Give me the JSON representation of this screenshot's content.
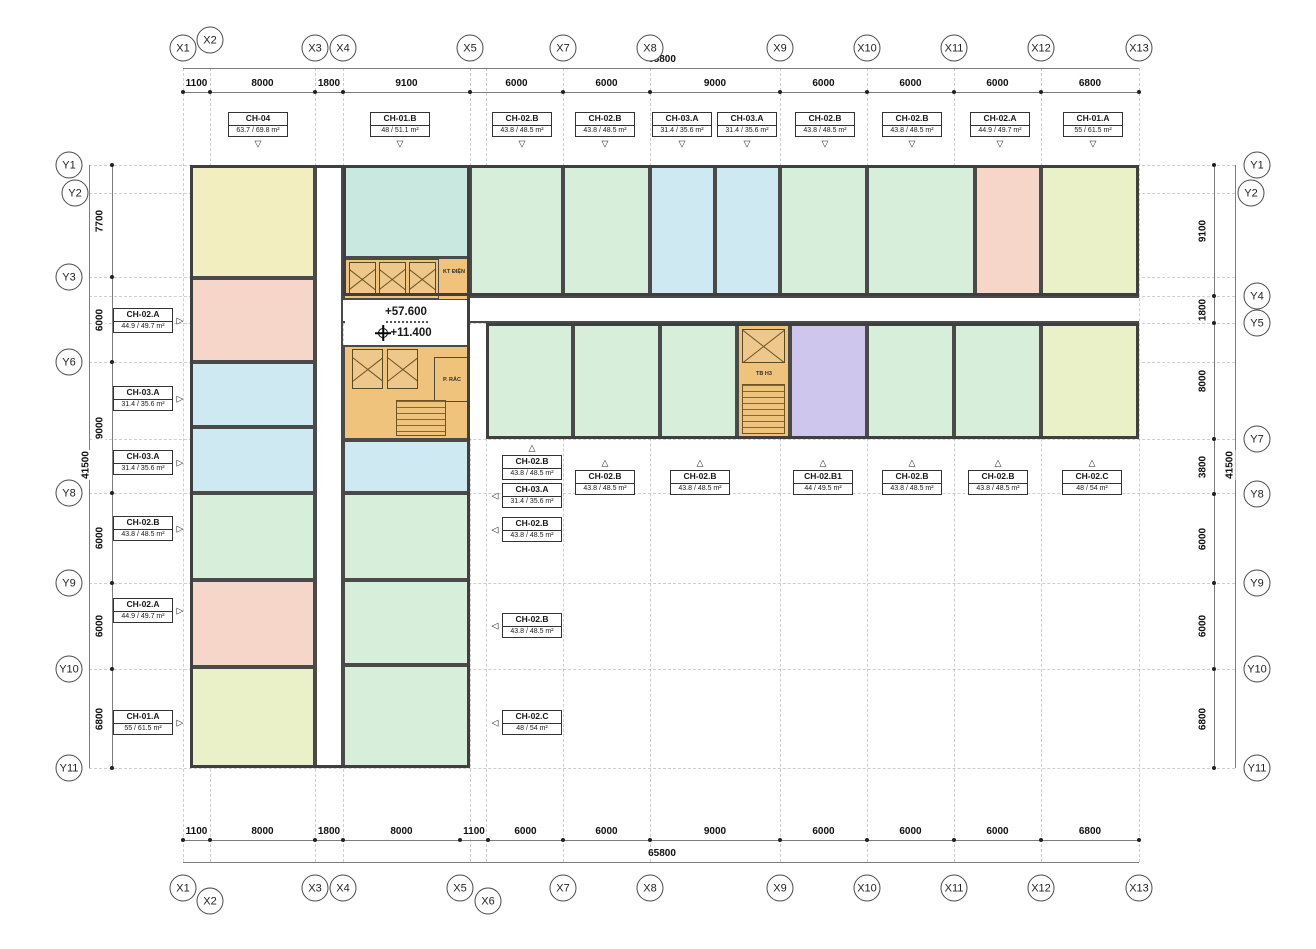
{
  "meta": {
    "doc_type": "apartment floor plan"
  },
  "totals": {
    "horizontal": "65800",
    "vertical": "41500"
  },
  "levels": {
    "upper": "+57.600",
    "lower": "+11.400"
  },
  "cores": {
    "electrical": "KT ĐIỆN",
    "trash": "P. RÁC",
    "stair": "TB H3"
  },
  "pointer_glyphs": {
    "down": "▽",
    "up": "△",
    "left": "◁",
    "right": "▷"
  },
  "palette": {
    "yellow": "#f3eec0",
    "pink": "#f5d6c8",
    "blue": "#cfe9f3",
    "mint": "#d6eeda",
    "teal": "#c8e8e0",
    "yellowgreen": "#eaf0c8",
    "purple": "#cfc6ed",
    "orange": "#f0c37d",
    "wall": "#4a4a4a",
    "line": "#7d7d7d"
  },
  "grid": {
    "top": [
      {
        "label": "X1",
        "x": 183,
        "y": 48
      },
      {
        "label": "X2",
        "x": 210,
        "y": 40
      },
      {
        "label": "X3",
        "x": 315,
        "y": 48
      },
      {
        "label": "X4",
        "x": 343,
        "y": 48
      },
      {
        "label": "X5",
        "x": 470,
        "y": 48
      },
      {
        "label": "X7",
        "x": 563,
        "y": 48
      },
      {
        "label": "X8",
        "x": 650,
        "y": 48
      },
      {
        "label": "X9",
        "x": 780,
        "y": 48
      },
      {
        "label": "X10",
        "x": 867,
        "y": 48
      },
      {
        "label": "X11",
        "x": 954,
        "y": 48
      },
      {
        "label": "X12",
        "x": 1041,
        "y": 48
      },
      {
        "label": "X13",
        "x": 1139,
        "y": 48
      }
    ],
    "bottom": [
      {
        "label": "X1",
        "x": 183,
        "y": 888
      },
      {
        "label": "X2",
        "x": 210,
        "y": 901
      },
      {
        "label": "X3",
        "x": 315,
        "y": 888
      },
      {
        "label": "X4",
        "x": 343,
        "y": 888
      },
      {
        "label": "X5",
        "x": 460,
        "y": 888
      },
      {
        "label": "X6",
        "x": 488,
        "y": 901
      },
      {
        "label": "X7",
        "x": 563,
        "y": 888
      },
      {
        "label": "X8",
        "x": 650,
        "y": 888
      },
      {
        "label": "X9",
        "x": 780,
        "y": 888
      },
      {
        "label": "X10",
        "x": 867,
        "y": 888
      },
      {
        "label": "X11",
        "x": 954,
        "y": 888
      },
      {
        "label": "X12",
        "x": 1041,
        "y": 888
      },
      {
        "label": "X13",
        "x": 1139,
        "y": 888
      }
    ],
    "left": [
      {
        "label": "Y1",
        "x": 69,
        "y": 165
      },
      {
        "label": "Y2",
        "x": 75,
        "y": 193
      },
      {
        "label": "Y3",
        "x": 69,
        "y": 277
      },
      {
        "label": "Y6",
        "x": 69,
        "y": 362
      },
      {
        "label": "Y8",
        "x": 69,
        "y": 493
      },
      {
        "label": "Y9",
        "x": 69,
        "y": 583
      },
      {
        "label": "Y10",
        "x": 69,
        "y": 669
      },
      {
        "label": "Y11",
        "x": 69,
        "y": 768
      }
    ],
    "right": [
      {
        "label": "Y1",
        "x": 1257,
        "y": 165
      },
      {
        "label": "Y2",
        "x": 1251,
        "y": 193
      },
      {
        "label": "Y4",
        "x": 1257,
        "y": 296
      },
      {
        "label": "Y5",
        "x": 1257,
        "y": 323
      },
      {
        "label": "Y7",
        "x": 1257,
        "y": 439
      },
      {
        "label": "Y8",
        "x": 1257,
        "y": 494
      },
      {
        "label": "Y9",
        "x": 1257,
        "y": 583
      },
      {
        "label": "Y10",
        "x": 1257,
        "y": 669
      },
      {
        "label": "Y11",
        "x": 1257,
        "y": 768
      }
    ]
  },
  "grid_lines": {
    "vertical": [
      183,
      210,
      315,
      343,
      470,
      486,
      563,
      650,
      780,
      867,
      954,
      1041,
      1139
    ],
    "horizontal": [
      165,
      193,
      277,
      296,
      323,
      362,
      439,
      493,
      583,
      669,
      768
    ]
  },
  "dims": {
    "top": {
      "line_y": 92,
      "label_y": 89,
      "segments": [
        [
          "1100",
          183,
          210
        ],
        [
          "8000",
          210,
          315
        ],
        [
          "1800",
          315,
          343
        ],
        [
          "9100",
          343,
          470
        ],
        [
          "6000",
          470,
          563
        ],
        [
          "6000",
          563,
          650
        ],
        [
          "9000",
          650,
          780
        ],
        [
          "6000",
          780,
          867
        ],
        [
          "6000",
          867,
          954
        ],
        [
          "6000",
          954,
          1041
        ],
        [
          "6800",
          1041,
          1139
        ]
      ]
    },
    "bottom": {
      "line_y": 840,
      "label_y": 837,
      "segments": [
        [
          "1100",
          183,
          210
        ],
        [
          "8000",
          210,
          315
        ],
        [
          "1800",
          315,
          343
        ],
        [
          "8000",
          343,
          460
        ],
        [
          "1100",
          460,
          488
        ],
        [
          "6000",
          488,
          563
        ],
        [
          "6000",
          563,
          650
        ],
        [
          "9000",
          650,
          780
        ],
        [
          "6000",
          780,
          867
        ],
        [
          "6000",
          867,
          954
        ],
        [
          "6000",
          954,
          1041
        ],
        [
          "6800",
          1041,
          1139
        ]
      ]
    },
    "left": {
      "line_x": 112,
      "label_x": 100,
      "segments": [
        [
          "7700",
          165,
          277
        ],
        [
          "6000",
          277,
          362
        ],
        [
          "9000",
          362,
          493
        ],
        [
          "6000",
          493,
          583
        ],
        [
          "6000",
          583,
          669
        ],
        [
          "6800",
          669,
          768
        ]
      ]
    },
    "right": {
      "line_x": 1214,
      "label_x": 1203,
      "segments": [
        [
          "9100",
          165,
          296
        ],
        [
          "1800",
          296,
          323
        ],
        [
          "8000",
          323,
          439
        ],
        [
          "3800",
          439,
          494
        ],
        [
          "6000",
          494,
          583
        ],
        [
          "6000",
          583,
          669
        ],
        [
          "6800",
          669,
          768
        ]
      ]
    }
  },
  "units": [
    {
      "name": "CH-04",
      "color": "yellow",
      "x": 190,
      "y": 165,
      "w": 125,
      "h": 113
    },
    {
      "name": "CH-02.A",
      "color": "pink",
      "x": 190,
      "y": 278,
      "w": 125,
      "h": 84
    },
    {
      "name": "CH-03.A",
      "color": "blue",
      "x": 190,
      "y": 362,
      "w": 125,
      "h": 65
    },
    {
      "name": "CH-03.A",
      "color": "blue",
      "x": 190,
      "y": 427,
      "w": 125,
      "h": 66
    },
    {
      "name": "CH-02.B",
      "color": "mint",
      "x": 190,
      "y": 493,
      "w": 125,
      "h": 87
    },
    {
      "name": "CH-02.A",
      "color": "pink",
      "x": 190,
      "y": 580,
      "w": 125,
      "h": 87
    },
    {
      "name": "CH-01.A",
      "color": "yellowgreen",
      "x": 190,
      "y": 667,
      "w": 125,
      "h": 101
    },
    {
      "name": "CH-01.B",
      "color": "teal",
      "x": 343,
      "y": 165,
      "w": 127,
      "h": 93
    },
    {
      "name": "CH-03.A",
      "color": "blue",
      "x": 343,
      "y": 440,
      "w": 127,
      "h": 53
    },
    {
      "name": "CH-02.B",
      "color": "mint",
      "x": 343,
      "y": 493,
      "w": 127,
      "h": 87
    },
    {
      "name": "CH-02.B",
      "color": "mint",
      "x": 343,
      "y": 580,
      "w": 127,
      "h": 85
    },
    {
      "name": "CH-02.C",
      "color": "mint",
      "x": 343,
      "y": 665,
      "w": 127,
      "h": 103
    },
    {
      "name": "CH-02.B",
      "color": "mint",
      "x": 470,
      "y": 165,
      "w": 93,
      "h": 131
    },
    {
      "name": "CH-02.B",
      "color": "mint",
      "x": 563,
      "y": 165,
      "w": 87,
      "h": 131
    },
    {
      "name": "CH-03.A",
      "color": "blue",
      "x": 650,
      "y": 165,
      "w": 65,
      "h": 131
    },
    {
      "name": "CH-03.A",
      "color": "blue",
      "x": 715,
      "y": 165,
      "w": 65,
      "h": 131
    },
    {
      "name": "CH-02.B",
      "color": "mint",
      "x": 780,
      "y": 165,
      "w": 87,
      "h": 131
    },
    {
      "name": "CH-02.B",
      "color": "mint",
      "x": 867,
      "y": 165,
      "w": 108,
      "h": 131
    },
    {
      "name": "CH-02.A",
      "color": "pink",
      "x": 975,
      "y": 165,
      "w": 66,
      "h": 131
    },
    {
      "name": "CH-01.A",
      "color": "yellowgreen",
      "x": 1041,
      "y": 165,
      "w": 98,
      "h": 131
    },
    {
      "name": "CH-02.B",
      "color": "mint",
      "x": 486,
      "y": 323,
      "w": 87,
      "h": 116
    },
    {
      "name": "CH-02.B",
      "color": "mint",
      "x": 573,
      "y": 323,
      "w": 87,
      "h": 116
    },
    {
      "name": "CH-02.B",
      "color": "mint",
      "x": 660,
      "y": 323,
      "w": 77,
      "h": 116
    },
    {
      "name": "CH-02.B1",
      "color": "purple",
      "x": 790,
      "y": 323,
      "w": 77,
      "h": 116
    },
    {
      "name": "CH-02.B",
      "color": "mint",
      "x": 867,
      "y": 323,
      "w": 87,
      "h": 116
    },
    {
      "name": "CH-02.B",
      "color": "mint",
      "x": 954,
      "y": 323,
      "w": 87,
      "h": 116
    },
    {
      "name": "CH-02.C",
      "color": "yellowgreen",
      "x": 1041,
      "y": 323,
      "w": 98,
      "h": 116
    }
  ],
  "tags": [
    {
      "name": "CH-04",
      "area": "63.7 / 69.8 m²",
      "x": 258,
      "y": 112,
      "ptr": "down"
    },
    {
      "name": "CH-01.B",
      "area": "48 / 51.1 m²",
      "x": 400,
      "y": 112,
      "ptr": "down"
    },
    {
      "name": "CH-02.B",
      "area": "43.8 / 48.5 m²",
      "x": 522,
      "y": 112,
      "ptr": "down"
    },
    {
      "name": "CH-02.B",
      "area": "43.8 / 48.5 m²",
      "x": 605,
      "y": 112,
      "ptr": "down"
    },
    {
      "name": "CH-03.A",
      "area": "31.4 / 35.6 m²",
      "x": 682,
      "y": 112,
      "ptr": "down"
    },
    {
      "name": "CH-03.A",
      "area": "31.4 / 35.6 m²",
      "x": 747,
      "y": 112,
      "ptr": "down"
    },
    {
      "name": "CH-02.B",
      "area": "43.8 / 48.5 m²",
      "x": 825,
      "y": 112,
      "ptr": "down"
    },
    {
      "name": "CH-02.B",
      "area": "43.8 / 48.5 m²",
      "x": 912,
      "y": 112,
      "ptr": "down"
    },
    {
      "name": "CH-02.A",
      "area": "44.9 / 49.7 m²",
      "x": 1000,
      "y": 112,
      "ptr": "down"
    },
    {
      "name": "CH-01.A",
      "area": "55 / 61.5 m²",
      "x": 1093,
      "y": 112,
      "ptr": "down"
    },
    {
      "name": "CH-02.A",
      "area": "44.9 / 49.7 m²",
      "x": 143,
      "y": 308,
      "ptr": "right"
    },
    {
      "name": "CH-03.A",
      "area": "31.4 / 35.6 m²",
      "x": 143,
      "y": 386,
      "ptr": "right"
    },
    {
      "name": "CH-03.A",
      "area": "31.4 / 35.6 m²",
      "x": 143,
      "y": 450,
      "ptr": "right"
    },
    {
      "name": "CH-02.B",
      "area": "43.8 / 48.5 m²",
      "x": 143,
      "y": 516,
      "ptr": "right"
    },
    {
      "name": "CH-02.A",
      "area": "44.9 / 49.7 m²",
      "x": 143,
      "y": 598,
      "ptr": "right"
    },
    {
      "name": "CH-01.A",
      "area": "55 / 61.5 m²",
      "x": 143,
      "y": 710,
      "ptr": "right"
    },
    {
      "name": "CH-02.B",
      "area": "43.8 / 48.5 m²",
      "x": 532,
      "y": 455,
      "ptr": "up"
    },
    {
      "name": "CH-03.A",
      "area": "31.4 / 35.6 m²",
      "x": 532,
      "y": 483,
      "ptr": "left"
    },
    {
      "name": "CH-02.B",
      "area": "43.8 / 48.5 m²",
      "x": 532,
      "y": 517,
      "ptr": "left"
    },
    {
      "name": "CH-02.B",
      "area": "43.8 / 48.5 m²",
      "x": 532,
      "y": 613,
      "ptr": "left"
    },
    {
      "name": "CH-02.C",
      "area": "48 / 54 m²",
      "x": 532,
      "y": 710,
      "ptr": "left"
    },
    {
      "name": "CH-02.B",
      "area": "43.8 / 48.5 m²",
      "x": 605,
      "y": 470,
      "ptr": "up"
    },
    {
      "name": "CH-02.B",
      "area": "43.8 / 48.5 m²",
      "x": 700,
      "y": 470,
      "ptr": "up"
    },
    {
      "name": "CH-02.B1",
      "area": "44 / 49.5 m²",
      "x": 823,
      "y": 470,
      "ptr": "up"
    },
    {
      "name": "CH-02.B",
      "area": "43.8 / 48.5 m²",
      "x": 912,
      "y": 470,
      "ptr": "up"
    },
    {
      "name": "CH-02.B",
      "area": "43.8 / 48.5 m²",
      "x": 998,
      "y": 470,
      "ptr": "up"
    },
    {
      "name": "CH-02.C",
      "area": "48 / 54 m²",
      "x": 1092,
      "y": 470,
      "ptr": "up"
    }
  ]
}
